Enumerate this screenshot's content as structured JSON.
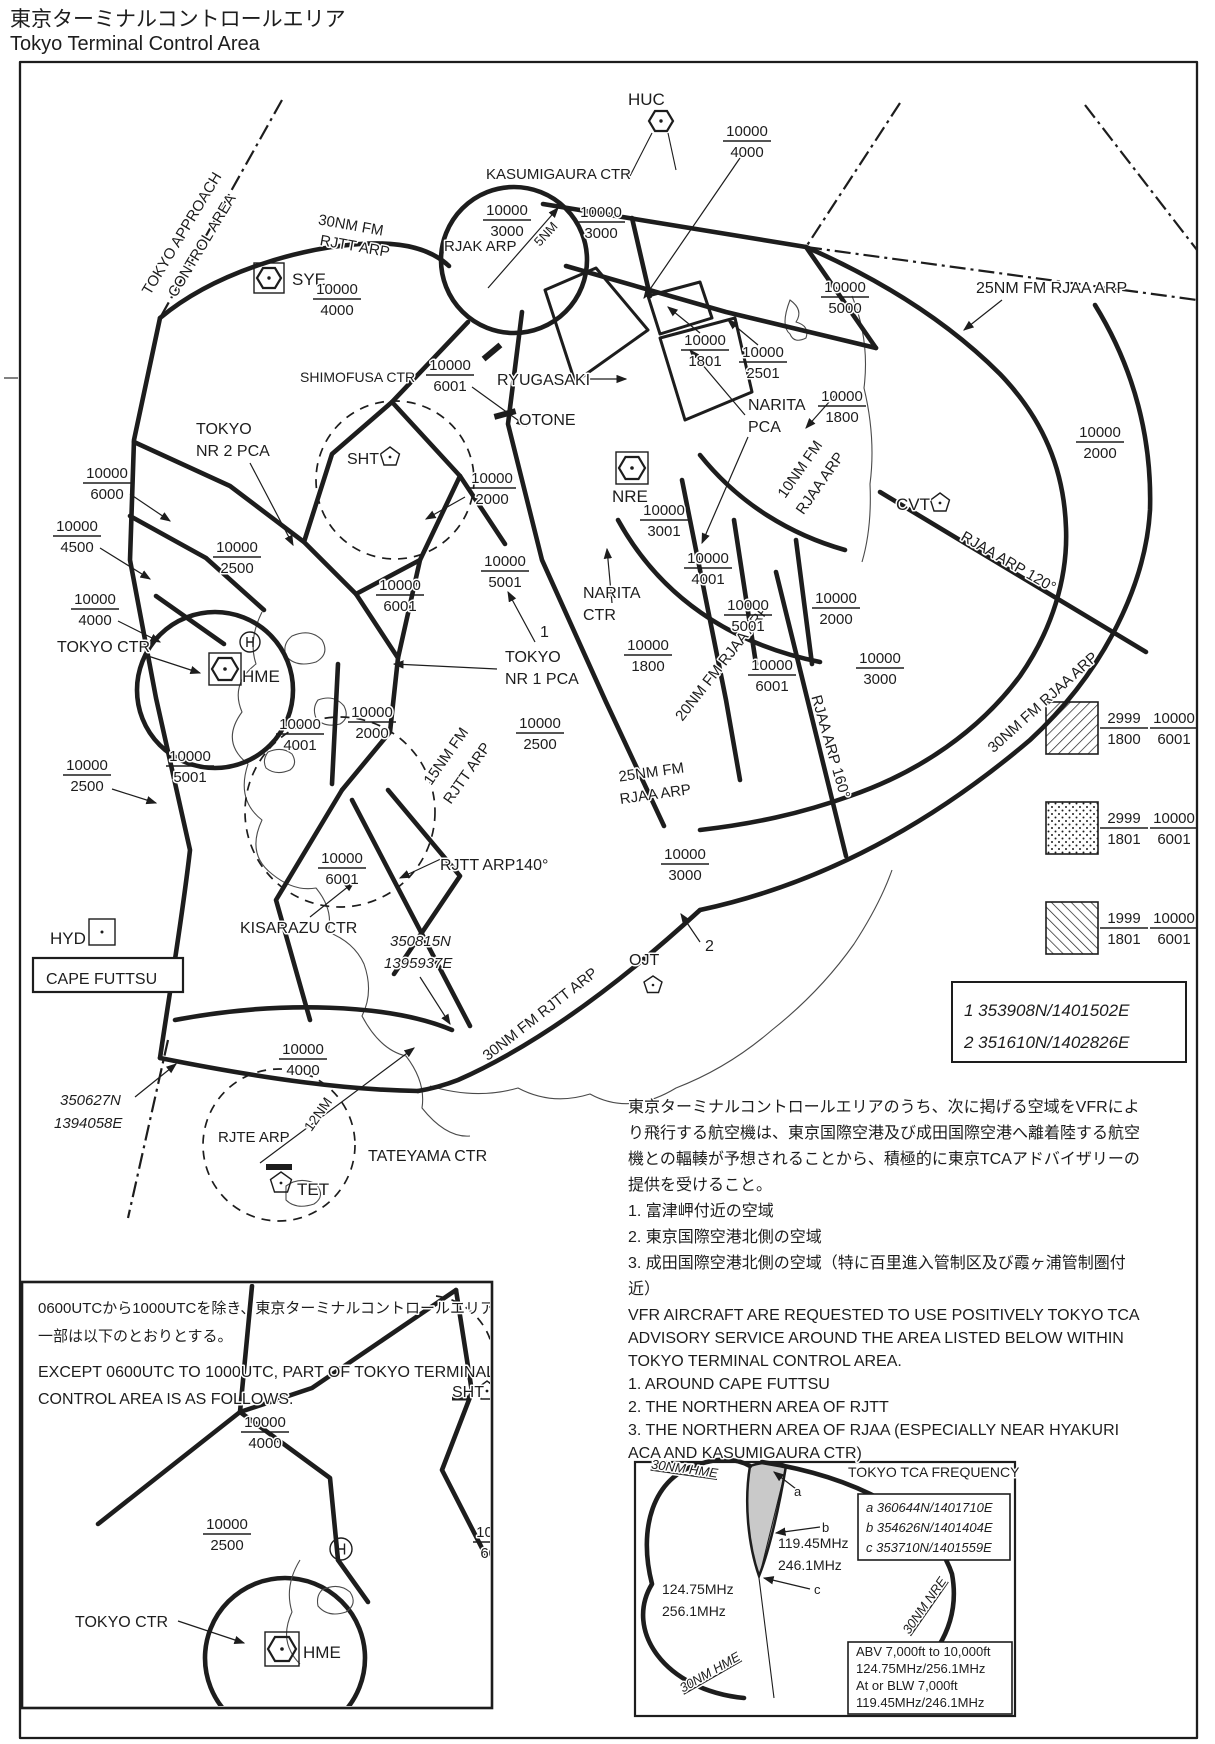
{
  "title": {
    "jp": "東京ターミナルコントロールエリア",
    "en": "Tokyo Terminal Control Area"
  },
  "colors": {
    "ink": "#1d1d1d",
    "paper": "#ffffff",
    "shaded_area": "#c9c9c9"
  },
  "map": {
    "texts": [
      {
        "n": "label-tokyo-approach",
        "t": "TOKYO APPROACH",
        "x": 186,
        "y": 236,
        "s": 15,
        "rot": -59,
        "a": "middle"
      },
      {
        "n": "label-control-area",
        "t": "CONTROL AREA",
        "x": 206,
        "y": 248,
        "s": 15,
        "rot": -59,
        "a": "middle"
      },
      {
        "n": "label-30nm-rjtt-top-1",
        "t": "30NM FM",
        "x": 350,
        "y": 230,
        "s": 15,
        "rot": 10,
        "a": "middle"
      },
      {
        "n": "label-30nm-rjtt-top-2",
        "t": "RJTT ARP",
        "x": 354,
        "y": 251,
        "s": 15,
        "rot": 10,
        "a": "middle"
      },
      {
        "n": "navaid-label-sye",
        "t": "SYE",
        "x": 292,
        "y": 285,
        "s": 17
      },
      {
        "n": "label-kasumigaura-ctr",
        "t": "KASUMIGAURA CTR",
        "x": 486,
        "y": 179,
        "s": 15
      },
      {
        "n": "label-rjak-arp",
        "t": "RJAK ARP",
        "x": 444,
        "y": 251,
        "s": 15
      },
      {
        "n": "label-5nm",
        "t": "5NM",
        "x": 549,
        "y": 237,
        "s": 13,
        "rot": -47,
        "a": "middle"
      },
      {
        "n": "navaid-label-huc",
        "t": "HUC",
        "x": 628,
        "y": 105,
        "s": 17
      },
      {
        "n": "label-25nm-rjaa",
        "t": "25NM FM RJAA ARP",
        "x": 976,
        "y": 293,
        "s": 16
      },
      {
        "n": "label-narita-pca-1",
        "t": "NARITA",
        "x": 748,
        "y": 410,
        "s": 16
      },
      {
        "n": "label-narita-pca-2",
        "t": "PCA",
        "x": 748,
        "y": 432,
        "s": 16
      },
      {
        "n": "label-shimofusa-ctr",
        "t": "SHIMOFUSA CTR",
        "x": 300,
        "y": 382,
        "s": 14
      },
      {
        "n": "label-ryugasaki",
        "t": "RYUGASAKI",
        "x": 497,
        "y": 385,
        "s": 16
      },
      {
        "n": "label-otone",
        "t": "OTONE",
        "x": 519,
        "y": 425,
        "s": 16
      },
      {
        "n": "label-10nm-rjaa-1",
        "t": "10NM FM",
        "x": 804,
        "y": 472,
        "s": 15,
        "rot": -55,
        "a": "middle"
      },
      {
        "n": "label-10nm-rjaa-2",
        "t": "RJAA ARP",
        "x": 824,
        "y": 486,
        "s": 15,
        "rot": -55,
        "a": "middle"
      },
      {
        "n": "navaid-label-cvt",
        "t": "CVT",
        "x": 896,
        "y": 510,
        "s": 17
      },
      {
        "n": "label-rjaa-120",
        "t": "RJAA ARP 120°",
        "x": 1006,
        "y": 566,
        "s": 15,
        "rot": 30,
        "a": "middle"
      },
      {
        "n": "label-tokyo-nr2-1",
        "t": "TOKYO",
        "x": 196,
        "y": 434,
        "s": 16
      },
      {
        "n": "label-tokyo-nr2-2",
        "t": "NR 2 PCA",
        "x": 196,
        "y": 456,
        "s": 16
      },
      {
        "n": "navaid-label-sht",
        "t": "SHT",
        "x": 347,
        "y": 464,
        "s": 16
      },
      {
        "n": "label-tokyo-ctr",
        "t": "TOKYO CTR",
        "x": 57,
        "y": 652,
        "s": 16
      },
      {
        "n": "navaid-label-hme",
        "t": "HME",
        "x": 242,
        "y": 682,
        "s": 17
      },
      {
        "n": "label-narita-ctr-1",
        "t": "NARITA",
        "x": 583,
        "y": 598,
        "s": 16
      },
      {
        "n": "label-narita-ctr-2",
        "t": "CTR",
        "x": 583,
        "y": 620,
        "s": 16
      },
      {
        "n": "label-point-1",
        "t": "1",
        "x": 540,
        "y": 637,
        "s": 16
      },
      {
        "n": "label-tokyo-nr1-1",
        "t": "TOKYO",
        "x": 505,
        "y": 662,
        "s": 16
      },
      {
        "n": "label-tokyo-nr1-2",
        "t": "NR 1 PCA",
        "x": 505,
        "y": 684,
        "s": 16
      },
      {
        "n": "navaid-label-nre",
        "t": "NRE",
        "x": 612,
        "y": 502,
        "s": 17
      },
      {
        "n": "label-15nm-rjtt-1",
        "t": "15NM FM",
        "x": 450,
        "y": 759,
        "s": 15,
        "rot": -55,
        "a": "middle"
      },
      {
        "n": "label-15nm-rjtt-2",
        "t": "RJTT ARP",
        "x": 471,
        "y": 776,
        "s": 15,
        "rot": -55,
        "a": "middle"
      },
      {
        "n": "label-rjtt-140",
        "t": "RJTT ARP140°",
        "x": 440,
        "y": 870,
        "s": 16
      },
      {
        "n": "label-20nm-rjaa",
        "t": "20NM FM RJAA ARP",
        "x": 726,
        "y": 666,
        "s": 15,
        "rot": -52,
        "a": "middle"
      },
      {
        "n": "label-25nm-rjaa-s-1",
        "t": "25NM FM",
        "x": 652,
        "y": 777,
        "s": 15,
        "rot": -8,
        "a": "middle"
      },
      {
        "n": "label-25nm-rjaa-s-2",
        "t": "RJAA ARP",
        "x": 656,
        "y": 799,
        "s": 15,
        "rot": -8,
        "a": "middle"
      },
      {
        "n": "label-rjaa-160",
        "t": "RJAA ARP 160°",
        "x": 826,
        "y": 748,
        "s": 15,
        "rot": 74,
        "a": "middle"
      },
      {
        "n": "label-30nm-rjaa",
        "t": "30NM FM RJAA ARP",
        "x": 1046,
        "y": 706,
        "s": 15,
        "rot": -42,
        "a": "middle"
      },
      {
        "n": "navaid-label-hyd",
        "t": "HYD",
        "x": 50,
        "y": 944,
        "s": 17
      },
      {
        "n": "label-cape-futtsu",
        "t": "CAPE FUTTSU",
        "x": 46,
        "y": 984,
        "s": 16
      },
      {
        "n": "label-kisarazu-ctr",
        "t": "KISARAZU CTR",
        "x": 240,
        "y": 933,
        "s": 16
      },
      {
        "n": "coord-350815n",
        "t": "350815N",
        "x": 390,
        "y": 946,
        "s": 15,
        "i": 1
      },
      {
        "n": "coord-1395937e",
        "t": "1395937E",
        "x": 384,
        "y": 968,
        "s": 15,
        "i": 1
      },
      {
        "n": "coord-350627n",
        "t": "350627N",
        "x": 60,
        "y": 1105,
        "s": 15,
        "i": 1
      },
      {
        "n": "coord-1394058e",
        "t": "1394058E",
        "x": 54,
        "y": 1128,
        "s": 15,
        "i": 1
      },
      {
        "n": "label-rjte-arp",
        "t": "RJTE ARP",
        "x": 218,
        "y": 1142,
        "s": 15
      },
      {
        "n": "label-12nm",
        "t": "12NM",
        "x": 322,
        "y": 1117,
        "s": 14,
        "rot": -55,
        "a": "middle"
      },
      {
        "n": "label-tateyama-ctr",
        "t": "TATEYAMA CTR",
        "x": 368,
        "y": 1161,
        "s": 16
      },
      {
        "n": "navaid-label-tet",
        "t": "TET",
        "x": 297,
        "y": 1195,
        "s": 17
      },
      {
        "n": "label-30nm-rjtt-bottom",
        "t": "30NM FM RJTT ARP",
        "x": 543,
        "y": 1018,
        "s": 15,
        "rot": -38,
        "a": "middle"
      },
      {
        "n": "navaid-label-ojt",
        "t": "OJT",
        "x": 629,
        "y": 965,
        "s": 16
      },
      {
        "n": "label-point-2",
        "t": "2",
        "x": 705,
        "y": 951,
        "s": 16
      },
      {
        "n": "inset-label-sht",
        "t": "SHT",
        "x": 452,
        "y": 1397,
        "s": 16,
        "layer": "inset"
      },
      {
        "n": "inset-label-tokyo-ctr",
        "t": "TOKYO CTR",
        "x": 75,
        "y": 1627,
        "s": 16,
        "layer": "inset"
      },
      {
        "n": "inset-label-hme",
        "t": "HME",
        "x": 303,
        "y": 1658,
        "s": 17,
        "layer": "inset"
      },
      {
        "n": "freq-title",
        "t": "TOKYO TCA FREQUENCY",
        "x": 848,
        "y": 1477,
        "s": 14
      },
      {
        "n": "freq-arc-30nm-hme-top",
        "t": "30NM HME",
        "x": 684,
        "y": 1473,
        "s": 13,
        "rot": 8,
        "a": "middle",
        "i": 1,
        "u": 1
      },
      {
        "n": "freq-point-a",
        "t": "a",
        "x": 794,
        "y": 1496,
        "s": 13
      },
      {
        "n": "freq-point-b",
        "t": "b",
        "x": 822,
        "y": 1532,
        "s": 13
      },
      {
        "n": "freq-point-c",
        "t": "c",
        "x": 814,
        "y": 1594,
        "s": 13
      },
      {
        "n": "freq-119",
        "t": "119.45MHz",
        "x": 778,
        "y": 1548,
        "s": 14
      },
      {
        "n": "freq-246",
        "t": "246.1MHz",
        "x": 778,
        "y": 1570,
        "s": 14
      },
      {
        "n": "freq-124",
        "t": "124.75MHz",
        "x": 662,
        "y": 1594,
        "s": 14
      },
      {
        "n": "freq-256",
        "t": "256.1MHz",
        "x": 662,
        "y": 1616,
        "s": 14
      },
      {
        "n": "freq-arc-30nm-nre",
        "t": "30NM NRE",
        "x": 928,
        "y": 1608,
        "s": 13,
        "rot": -55,
        "a": "middle",
        "i": 1,
        "u": 1
      },
      {
        "n": "freq-arc-30nm-hme-bottom",
        "t": "30NM HME",
        "x": 712,
        "y": 1676,
        "s": 13,
        "rot": -30,
        "a": "middle",
        "i": 1,
        "u": 1
      }
    ],
    "fractions": [
      {
        "top": "10000",
        "bottom": "4000",
        "x": 337,
        "y": 299
      },
      {
        "top": "10000",
        "bottom": "4000",
        "x": 747,
        "y": 141
      },
      {
        "top": "10000",
        "bottom": "3000",
        "x": 507,
        "y": 220
      },
      {
        "top": "10000",
        "bottom": "3000",
        "x": 601,
        "y": 222
      },
      {
        "top": "10000",
        "bottom": "5000",
        "x": 845,
        "y": 297
      },
      {
        "top": "10000",
        "bottom": "1801",
        "x": 705,
        "y": 350
      },
      {
        "top": "10000",
        "bottom": "2501",
        "x": 763,
        "y": 362
      },
      {
        "top": "10000",
        "bottom": "2000",
        "x": 1100,
        "y": 442
      },
      {
        "top": "10000",
        "bottom": "6001",
        "x": 450,
        "y": 375
      },
      {
        "top": "10000",
        "bottom": "6000",
        "x": 107,
        "y": 483
      },
      {
        "top": "10000",
        "bottom": "4500",
        "x": 77,
        "y": 536
      },
      {
        "top": "10000",
        "bottom": "4000",
        "x": 95,
        "y": 609
      },
      {
        "top": "10000",
        "bottom": "2500",
        "x": 237,
        "y": 557
      },
      {
        "top": "10000",
        "bottom": "2000",
        "x": 492,
        "y": 488
      },
      {
        "top": "10000",
        "bottom": "6001",
        "x": 400,
        "y": 595
      },
      {
        "top": "10000",
        "bottom": "5001",
        "x": 505,
        "y": 571
      },
      {
        "top": "10000",
        "bottom": "1800",
        "x": 842,
        "y": 406
      },
      {
        "top": "10000",
        "bottom": "3001",
        "x": 664,
        "y": 520
      },
      {
        "top": "10000",
        "bottom": "4001",
        "x": 708,
        "y": 568
      },
      {
        "top": "10000",
        "bottom": "5001",
        "x": 748,
        "y": 615
      },
      {
        "top": "10000",
        "bottom": "2000",
        "x": 836,
        "y": 608
      },
      {
        "top": "10000",
        "bottom": "6001",
        "x": 772,
        "y": 675
      },
      {
        "top": "10000",
        "bottom": "3000",
        "x": 880,
        "y": 668
      },
      {
        "top": "10000",
        "bottom": "1800",
        "x": 648,
        "y": 655
      },
      {
        "top": "10000",
        "bottom": "2500",
        "x": 540,
        "y": 733
      },
      {
        "top": "10000",
        "bottom": "4001",
        "x": 300,
        "y": 734
      },
      {
        "top": "10000",
        "bottom": "2000",
        "x": 372,
        "y": 722
      },
      {
        "top": "10000",
        "bottom": "2500",
        "x": 87,
        "y": 775
      },
      {
        "top": "10000",
        "bottom": "5001",
        "x": 190,
        "y": 766
      },
      {
        "top": "10000",
        "bottom": "6001",
        "x": 342,
        "y": 868
      },
      {
        "top": "10000",
        "bottom": "3000",
        "x": 685,
        "y": 864
      },
      {
        "top": "10000",
        "bottom": "4000",
        "x": 303,
        "y": 1059
      },
      {
        "top": "10000",
        "bottom": "4000",
        "x": 265,
        "y": 1432,
        "layer": "inset"
      },
      {
        "top": "10000",
        "bottom": "2500",
        "x": 227,
        "y": 1534,
        "layer": "inset"
      },
      {
        "top": "10000",
        "bottom": "6001",
        "x": 497,
        "y": 1542,
        "layer": "inset"
      }
    ]
  },
  "legend": {
    "rows": [
      {
        "hatch": "down",
        "l": {
          "top": "2999",
          "bottom": "1800"
        },
        "r": {
          "top": "10000",
          "bottom": "6001"
        }
      },
      {
        "hatch": "dots",
        "l": {
          "top": "2999",
          "bottom": "1801"
        },
        "r": {
          "top": "10000",
          "bottom": "6001"
        }
      },
      {
        "hatch": "up",
        "l": {
          "top": "1999",
          "bottom": "1801"
        },
        "r": {
          "top": "10000",
          "bottom": "6001"
        }
      }
    ]
  },
  "coord_box": [
    "1 353908N/1401502E",
    "2 351610N/1402826E"
  ],
  "notes": {
    "jp": [
      "東京ターミナルコントロールエリアのうち、次に掲げる空域をVFRによ",
      "り飛行する航空機は、東京国際空港及び成田国際空港へ離着陸する航空",
      "機との輻輳が予想されることから、積極的に東京TCAアドバイザリーの",
      "提供を受けること。",
      "1. 富津岬付近の空域",
      "2. 東京国際空港北側の空域",
      "3. 成田国際空港北側の空域（特に百里進入管制区及び霞ヶ浦管制圏付",
      "  近）"
    ],
    "en": [
      "VFR AIRCRAFT ARE REQUESTED TO USE POSITIVELY TOKYO TCA",
      "ADVISORY SERVICE AROUND THE AREA LISTED BELOW WITHIN",
      "TOKYO TERMINAL CONTROL AREA.",
      "1. AROUND CAPE FUTTSU",
      "2. THE NORTHERN AREA OF RJTT",
      "3. THE NORTHERN AREA OF RJAA (ESPECIALLY NEAR HYAKURI",
      "   ACA AND KASUMIGAURA CTR)"
    ]
  },
  "inset": {
    "jp": [
      "0600UTCから1000UTCを除き、東京ターミナルコントロールエリアの",
      "一部は以下のとおりとする。"
    ],
    "en": [
      "EXCEPT 0600UTC TO 1000UTC, PART OF TOKYO TERMINAL",
      "CONTROL AREA IS AS FOLLOWS."
    ]
  },
  "freq": {
    "title": "TOKYO TCA FREQUENCY",
    "coords": [
      "a 360644N/1401710E",
      "b 354626N/1401404E",
      "c 353710N/1401559E"
    ],
    "note": [
      "ABV 7,000ft to 10,000ft",
      "124.75MHz/256.1MHz",
      "At or BLW 7,000ft",
      "119.45MHz/246.1MHz"
    ]
  }
}
